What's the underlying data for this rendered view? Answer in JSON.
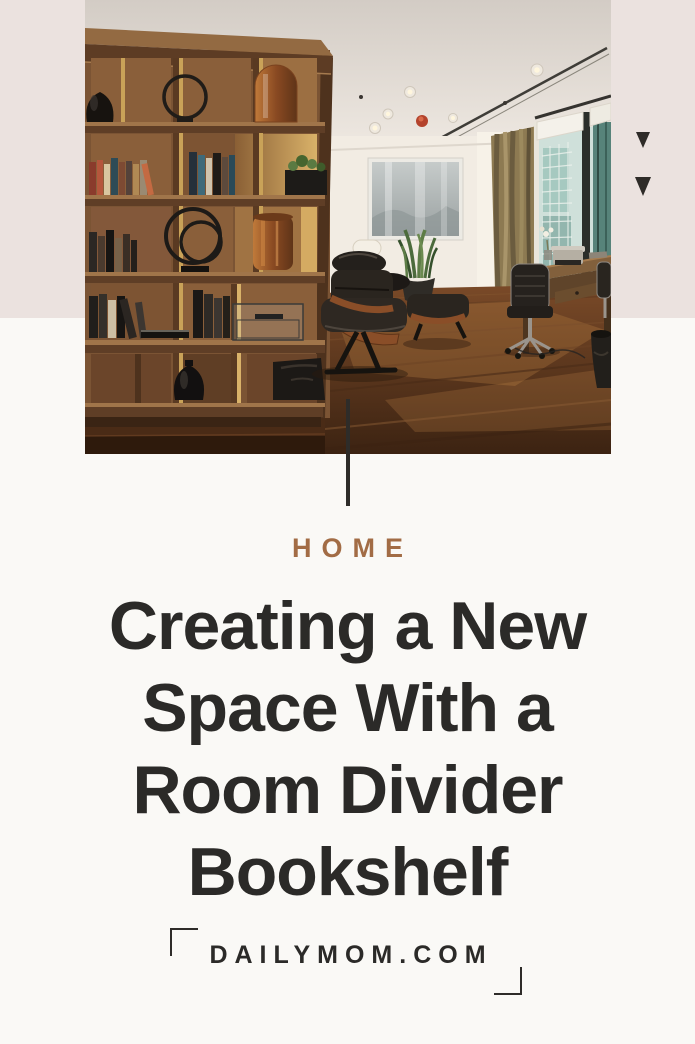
{
  "page": {
    "background_top_color": "#ebe2df",
    "background_bottom_color": "#faf9f6"
  },
  "photo": {
    "description": "Modern home office interior with a walnut room divider bookshelf holding books, ring sculptures and amber glass vases; Eames lounge chair and ottoman, snake plant, framed misty artwork, olive curtain, city window, wooden desk with typewriter and office chair on a warm wood plank floor"
  },
  "decor": {
    "triangle_1": "triangle-down",
    "triangle_2": "triangle-down",
    "line_color": "#2e2c29",
    "triangle_color": "#2e2b28",
    "bracket_color": "#2e2c29"
  },
  "category": {
    "label": "HOME",
    "color": "#a26c45"
  },
  "title": {
    "text": "Creating a New Space With a Room Divider Bookshelf",
    "lines": [
      "Creating a New",
      "Space With a",
      "Room Divider",
      "Bookshelf"
    ],
    "color": "#2b2a28"
  },
  "footer": {
    "site": "DAILYMOM.COM",
    "color": "#2b2a28"
  }
}
